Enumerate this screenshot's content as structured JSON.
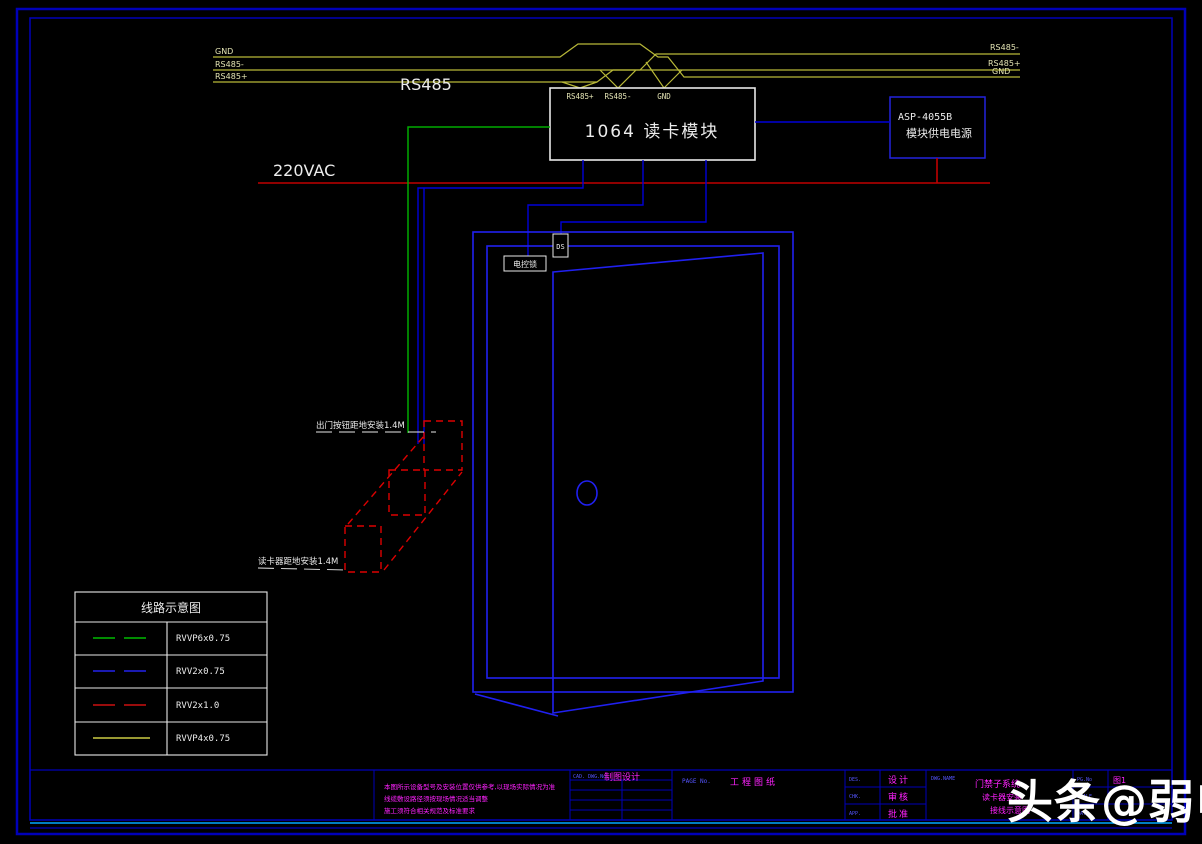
{
  "colors": {
    "background": "#000000",
    "frame_blue": "#0000b8",
    "accent_cyan": "#00a8ff",
    "wire_blue": "#0000d8",
    "door_blue": "#2020f0",
    "wire_green": "#00aa00",
    "wire_red": "#c00000",
    "bus_yellow": "#b8b838",
    "text_white": "#ececec",
    "text_magenta": "#ff22ff",
    "label_blue": "#5555ff"
  },
  "bus": {
    "title": "RS485",
    "left_labels": [
      "GND",
      "RS485-",
      "RS485+"
    ],
    "right_labels": [
      "RS485-",
      "RS485+",
      "GND"
    ]
  },
  "reader_module": {
    "title": "1064 读卡模块",
    "terminals": [
      "RS485+",
      "RS485-",
      "GND"
    ]
  },
  "power_module": {
    "model": "ASP-4055B",
    "name": "模块供电电源"
  },
  "power_line_label": "220VAC",
  "door": {
    "sensor_label": "DS",
    "lock_label": "电控锁"
  },
  "wall_devices": {
    "top_note": "出门按钮距地安装1.4M",
    "bottom_note": "读卡器距地安装1.4M"
  },
  "legend": {
    "title": "线路示意图",
    "rows": [
      {
        "spec": "RVVP6x0.75",
        "color": "#00bb00",
        "dash": "22 9"
      },
      {
        "spec": "RVV2x0.75",
        "color": "#2222ee",
        "dash": "22 9"
      },
      {
        "spec": "RVV2x1.0",
        "color": "#cc1111",
        "dash": "22 9"
      },
      {
        "spec": "RVVP4x0.75",
        "color": "#cccc44",
        "dash": ""
      }
    ]
  },
  "titleblock": {
    "notes": [
      "本图所示设备型号及安装位置仅供参考,以现场实际情况为准",
      "线缆敷设路径须按现场情况适当调整",
      "施工须符合相关规范及标准要求"
    ],
    "cad_cell": {
      "label": "CAD. DWG.No.",
      "value": "制图设计"
    },
    "page_cell": {
      "label": "PAGE No.",
      "value": "工程图纸"
    },
    "sign_rows": [
      {
        "label": "DES.",
        "value": "设计"
      },
      {
        "label": "CHK.",
        "value": "审核"
      },
      {
        "label": "APP.",
        "value": "批准"
      }
    ],
    "name_cell": {
      "label": "DWG.NAME",
      "lines": [
        "门禁子系统",
        "读卡器安装",
        "接线示意图"
      ]
    },
    "meta_rows": [
      {
        "label": "PG.No",
        "value": "图1"
      },
      {
        "label": "SCALE",
        "value": ""
      },
      {
        "label": "DATE",
        "value": ""
      }
    ]
  },
  "watermark": "头条@弱电"
}
